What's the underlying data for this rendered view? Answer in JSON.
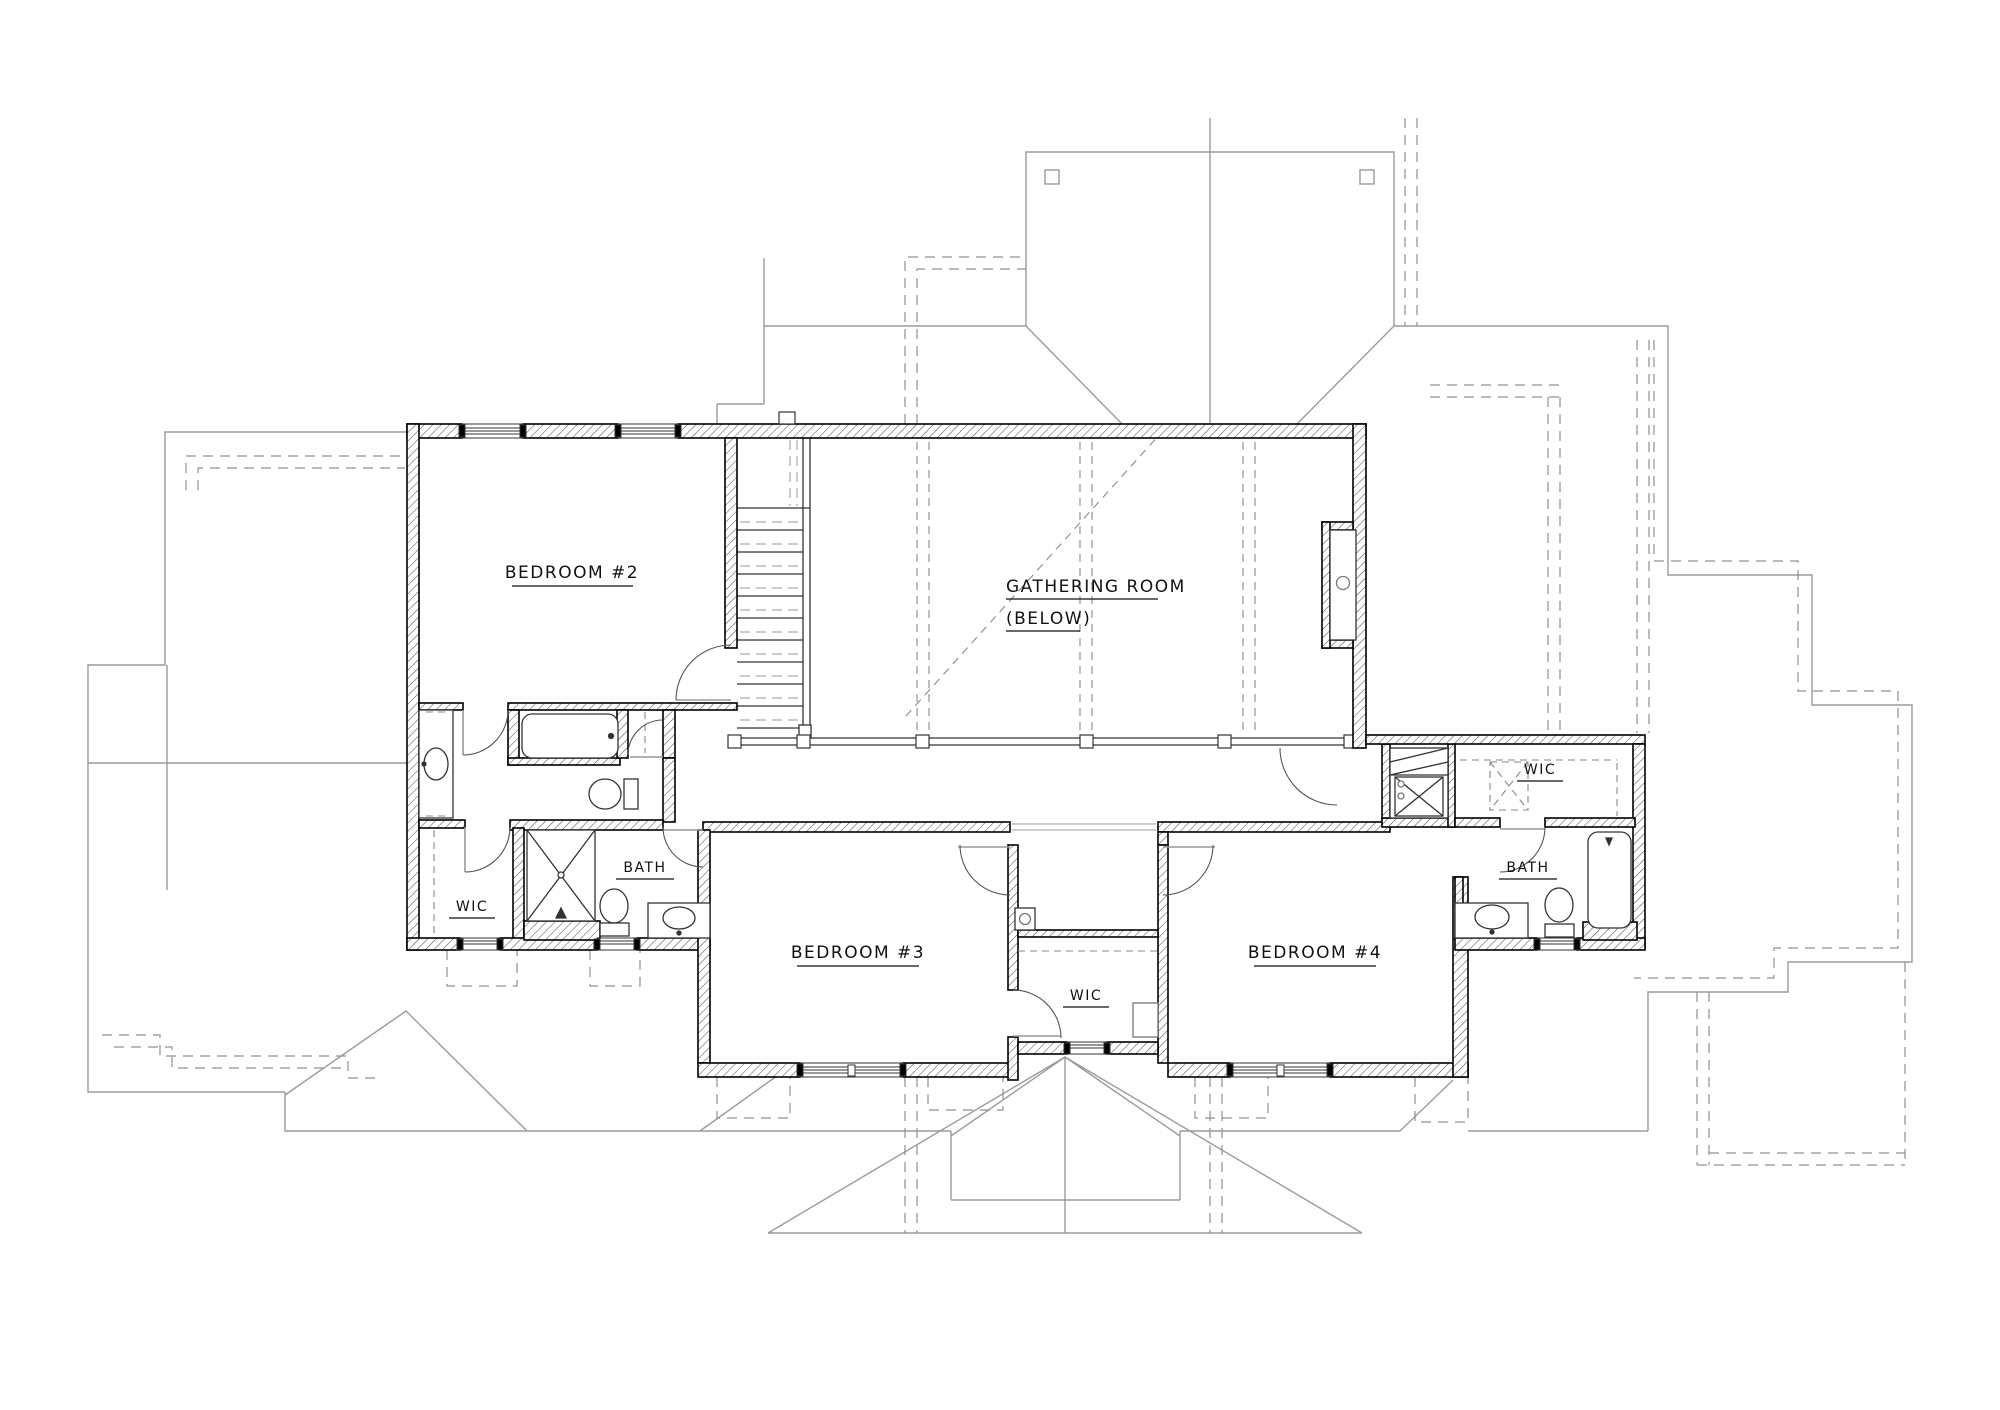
{
  "labels": {
    "bedroom2": "BEDROOM #2",
    "gathering_line1": "GATHERING ROOM",
    "gathering_line2": "(BELOW)",
    "bedroom3": "BEDROOM #3",
    "bedroom4": "BEDROOM #4",
    "wic_left": "WIC",
    "wic_center": "WIC",
    "wic_right": "WIC",
    "bath_left": "BATH",
    "bath_right": "BATH"
  },
  "colors": {
    "wall_line": "#000000",
    "hatch_line": "#555555",
    "roof_line": "#9b9b9b",
    "dash_line": "#909090",
    "fixture_line": "#333333",
    "text": "#111111"
  }
}
